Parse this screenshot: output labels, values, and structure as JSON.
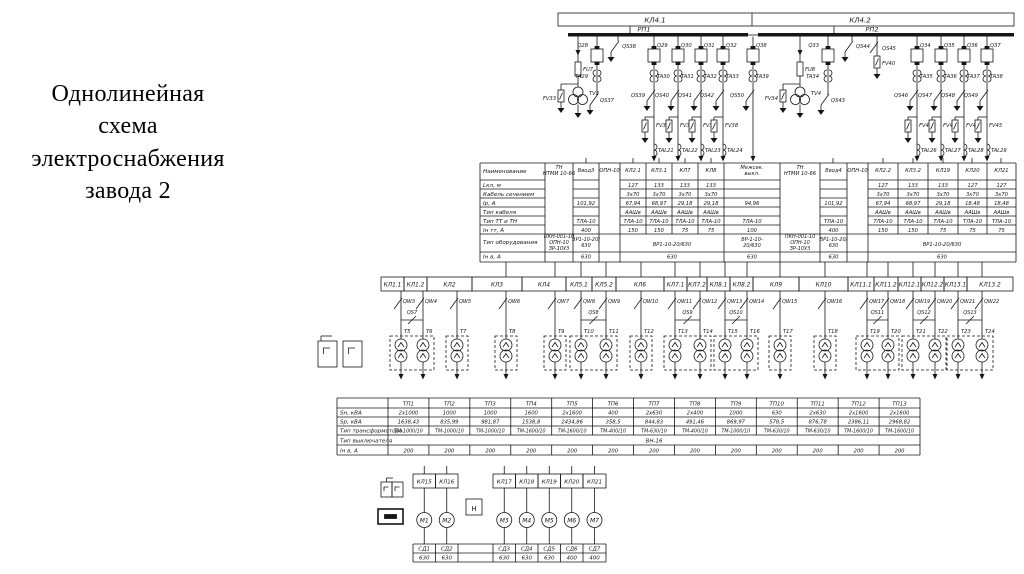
{
  "slide": {
    "title_lines": [
      "Однолинейная",
      "схема",
      "электроснабжения",
      "завода 2"
    ]
  },
  "supply": {
    "feeder_boxes": [
      "КЛ4.1",
      "КЛ4.2"
    ],
    "bus_labels": [
      "РП1",
      "РП2"
    ]
  },
  "rp1": {
    "vt_cell": {
      "fuse": "FU7",
      "vt": "TV3",
      "arrester": "FV33"
    },
    "input_cell": {
      "breaker": "Q28",
      "ct": "TA29",
      "qs": "QS37"
    },
    "bus_disconnector": "QS38",
    "feeders": [
      {
        "q": "Q29",
        "ta": "TA30",
        "qs": "QS39",
        "fv": "FV35",
        "tal": "TAL21"
      },
      {
        "q": "Q30",
        "ta": "TA31",
        "qs": "QS40",
        "fv": "FV36",
        "tal": "TAL22"
      },
      {
        "q": "Q31",
        "ta": "TA32",
        "qs": "QS41",
        "fv": "FV37",
        "tal": "TAL23"
      },
      {
        "q": "Q32",
        "ta": "TA33",
        "qs": "QS42",
        "fv": "FV38",
        "tal": "TAL24"
      }
    ]
  },
  "tie": {
    "q": "Q38",
    "ta": "TA39",
    "qs": "QS50"
  },
  "rp2": {
    "vt_cell": {
      "fuse": "FU8",
      "vt": "TV4",
      "arrester": "FV34"
    },
    "input_cell": {
      "breaker": "Q33",
      "ct": "TA34",
      "qs": "QS43"
    },
    "bus_disconnector": "QS44",
    "arrester_cell": {
      "fv": "FV40",
      "qs": "QS45"
    },
    "feeders": [
      {
        "q": "Q34",
        "ta": "TA35",
        "qs": "QS46",
        "fv": "FV42",
        "tal": "TAL26"
      },
      {
        "q": "Q35",
        "ta": "TA36",
        "qs": "QS47",
        "fv": "FV43",
        "tal": "TAL27"
      },
      {
        "q": "Q36",
        "ta": "TA37",
        "qs": "QS48",
        "fv": "FV44",
        "tal": "TAL28"
      },
      {
        "q": "Q37",
        "ta": "TA38",
        "qs": "QS49",
        "fv": "FV45",
        "tal": "TAL29"
      }
    ]
  },
  "spec_table": {
    "row_labels": [
      "Наименование",
      "Lкл, м",
      "Кабель сечением",
      "Iр, А",
      "Тип кабеля",
      "Тип ТТ и ТН",
      "Iн тт, А",
      "Тип оборудования",
      "Iн в, А"
    ],
    "columns": [
      {
        "header": "ТН\nНТМИ 10-66",
        "type": "tn",
        "equip": "ПКН-001-10\nОПН-10\nЗР-10У3"
      },
      {
        "header": "Ввод3",
        "type": "vvod",
        "ir": "101,92",
        "tt": "ТЛА-10",
        "itt": "400",
        "equip": "ВР1-10-20/\n630",
        "inv": "630"
      },
      {
        "header": "ОПН-10",
        "type": "opn"
      },
      {
        "header": "КЛ2.1",
        "group": "g1",
        "l": "127",
        "s": "3х70",
        "ir": "67,94",
        "cable": "ААШв",
        "tt": "ТЛА-10",
        "itt": "150"
      },
      {
        "header": "КЛ3.1",
        "group": "g1",
        "l": "133",
        "s": "3х70",
        "ir": "68,97",
        "cable": "ААШв",
        "tt": "ТЛА-10",
        "itt": "150"
      },
      {
        "header": "КЛ7",
        "group": "g1",
        "l": "133",
        "s": "3х70",
        "ir": "29,18",
        "cable": "ААШв",
        "tt": "ТЛА-10",
        "itt": "75"
      },
      {
        "header": "КЛ8",
        "group": "g1",
        "l": "133",
        "s": "3х70",
        "ir": "29,18",
        "cable": "ААШв",
        "tt": "ТЛА-10",
        "itt": "75"
      },
      {
        "header": "Межсек.\nвыкл.",
        "type": "vvod",
        "ir": "94,96",
        "tt": "ТЛА-10",
        "itt": "100",
        "equip": "ВР-1-10-\n20/630",
        "inv": "630"
      },
      {
        "header": "ТН\nНТМИ 10-66",
        "type": "tn",
        "equip": "ПКН-001-10\nОПН-10\nЗР-10У3"
      },
      {
        "header": "Ввод4",
        "type": "vvod",
        "ir": "101,92",
        "tt": "ТЛА-10",
        "itt": "400",
        "equip": "ВР1-10-20/\n630",
        "inv": "630"
      },
      {
        "header": "ОПН-10",
        "type": "opn"
      },
      {
        "header": "КЛ2.2",
        "group": "g2",
        "l": "127",
        "s": "3х70",
        "ir": "67,94",
        "cable": "ААШв",
        "tt": "ТЛА-10",
        "itt": "150"
      },
      {
        "header": "КЛ3.2",
        "group": "g2",
        "l": "133",
        "s": "3х70",
        "ir": "68,97",
        "cable": "ААШв",
        "tt": "ТЛА-10",
        "itt": "150"
      },
      {
        "header": "КЛ19",
        "group": "g2",
        "l": "133",
        "s": "3х70",
        "ir": "29,18",
        "cable": "ААШв",
        "tt": "ТЛА-10",
        "itt": "75"
      },
      {
        "header": "КЛ20",
        "group": "g2",
        "l": "127",
        "s": "3х70",
        "ir": "18,48",
        "cable": "ААШв",
        "tt": "ТЛА-10",
        "itt": "75"
      },
      {
        "header": "КЛ21",
        "group": "g2",
        "l": "127",
        "s": "3х70",
        "ir": "18,48",
        "cable": "ААШв",
        "tt": "ТЛА-10",
        "itt": "75"
      }
    ],
    "merged": {
      "g1": {
        "equip": "ВР1-10-20/630",
        "inv": "630"
      },
      "g2": {
        "equip": "ВР1-10-20/630",
        "inv": "630"
      }
    }
  },
  "distribution": {
    "cable_labels": [
      "КЛ1.1",
      "КЛ1.2",
      "КЛ2",
      "КЛ3",
      "КЛ4",
      "КЛ5.1",
      "КЛ5.2",
      "КЛ6",
      "КЛ7.1",
      "КЛ7.2",
      "КЛ8.1",
      "КЛ8.2",
      "КЛ9",
      "КЛ10",
      "КЛ11.1",
      "КЛ11.2",
      "КЛ12.1",
      "КЛ12.2",
      "КЛ13.1",
      "КЛ13.2"
    ],
    "switch_labels": [
      "QW3",
      "QW4",
      "QW5",
      "QW6",
      "QW7",
      "QW8",
      "QW9",
      "QW10",
      "QW11",
      "QW12",
      "QW13",
      "QW14",
      "QW15",
      "QW16",
      "QW17",
      "QW18",
      "QW19",
      "QW20",
      "QW21",
      "QW22"
    ],
    "transformer_labels": [
      "Т5",
      "Т6",
      "Т7",
      "Т8",
      "Т9",
      "Т10",
      "Т11",
      "Т12",
      "Т13",
      "Т14",
      "Т15",
      "Т16",
      "Т17",
      "Т18",
      "Т19",
      "Т20",
      "Т21",
      "Т22",
      "Т23",
      "Т24"
    ],
    "substations": [
      {
        "name": "ТП1",
        "transformers": [
          0,
          1
        ],
        "qs": "QS7"
      },
      {
        "name": "ТП2",
        "transformers": [
          2
        ]
      },
      {
        "name": "ТП3",
        "transformers": [
          3
        ]
      },
      {
        "name": "ТП4",
        "transformers": [
          4
        ]
      },
      {
        "name": "ТП5",
        "transformers": [
          5,
          6
        ],
        "qs": "QS8"
      },
      {
        "name": "ТП6",
        "transformers": [
          7
        ]
      },
      {
        "name": "ТП7",
        "transformers": [
          8,
          9
        ],
        "qs": "QS9"
      },
      {
        "name": "ТП8",
        "transformers": [
          10,
          11
        ],
        "qs": "QS10"
      },
      {
        "name": "ТП9",
        "transformers": [
          12
        ]
      },
      {
        "name": "ТП10",
        "transformers": [
          13
        ]
      },
      {
        "name": "ТП11",
        "transformers": [
          14,
          15
        ],
        "qs": "QS11"
      },
      {
        "name": "ТП12",
        "transformers": [
          16,
          17
        ],
        "qs": "QS12"
      },
      {
        "name": "ТП13",
        "transformers": [
          18,
          19
        ],
        "qs": "QS13"
      }
    ]
  },
  "tp_table": {
    "row_labels": [
      "Sн, кВА",
      "Sр, кВА",
      "Тип трансформатора",
      "Тип выключателя",
      "Iн в, А"
    ],
    "col_headers": [
      "ТП1",
      "ТП2",
      "ТП3",
      "ТП4",
      "ТП5",
      "ТП6",
      "ТП7",
      "ТП8",
      "ТП9",
      "ТП10",
      "ТП11",
      "ТП12",
      "ТП13"
    ],
    "sn": [
      "2х1000",
      "1000",
      "1000",
      "1600",
      "2х1600",
      "400",
      "2х630",
      "2х400",
      "1000",
      "630",
      "2х630",
      "2х1600",
      "2х1600"
    ],
    "sr": [
      "1638,43",
      "835,99",
      "981,87",
      "1538,8",
      "2434,86",
      "358,5",
      "844,83",
      "491,46",
      "869,97",
      "578,5",
      "876,78",
      "2386,11",
      "2968,82"
    ],
    "tr_type": [
      "ТМ-1000/10",
      "ТМ-1000/10",
      "ТМ-1000/10",
      "ТМ-1600/10",
      "ТМ-1600/10",
      "ТМ-400/10",
      "ТМ-630/10",
      "ТМ-400/10",
      "ТМ-1000/10",
      "ТМ-630/10",
      "ТМ-630/10",
      "ТМ-1600/10",
      "ТМ-1600/10"
    ],
    "breaker_type": "ВН-16",
    "inv": [
      "200",
      "200",
      "200",
      "200",
      "200",
      "200",
      "200",
      "200",
      "200",
      "200",
      "200",
      "200",
      "200"
    ]
  },
  "motor_section": {
    "cables_left": [
      "КЛ15",
      "КЛ16"
    ],
    "cables_right": [
      "КЛ17",
      "КЛ18",
      "КЛ19",
      "КЛ20",
      "КЛ21"
    ],
    "motors": [
      "М1",
      "М2",
      "М3",
      "М4",
      "М5",
      "М6",
      "М7"
    ],
    "box_label": "Н",
    "sd_table": {
      "labels": [
        "СД1",
        "СД2",
        "СД3",
        "СД4",
        "СД5",
        "СД6",
        "СД7"
      ],
      "values": [
        "630",
        "630",
        "630",
        "630",
        "630",
        "400",
        "400"
      ]
    }
  }
}
